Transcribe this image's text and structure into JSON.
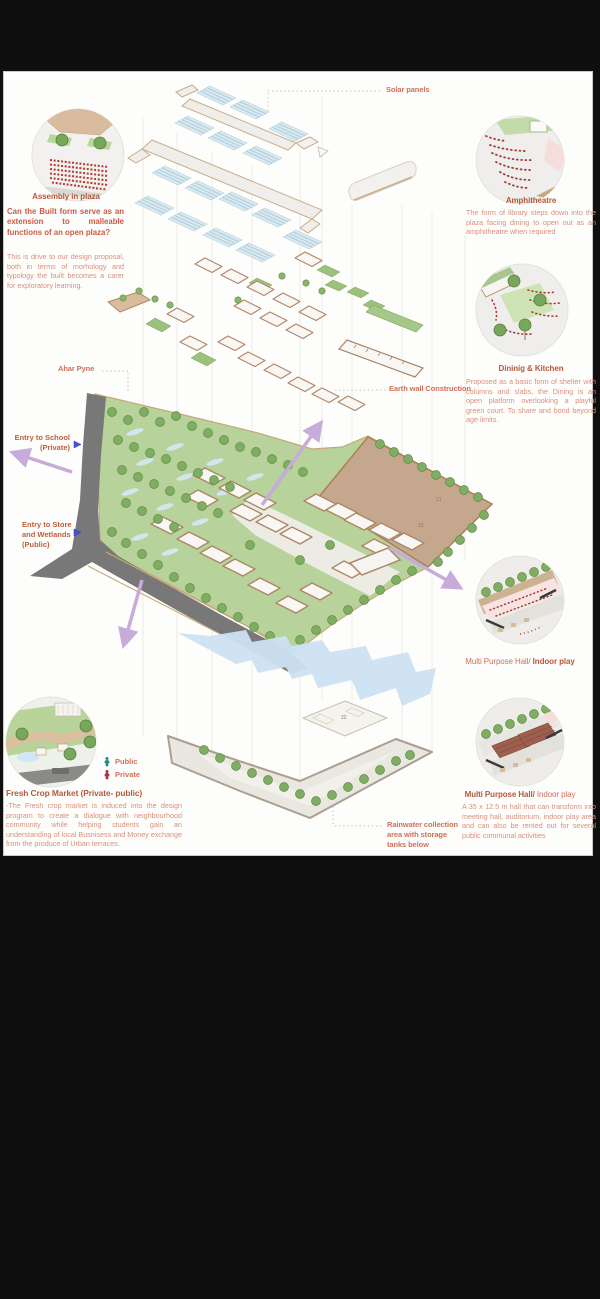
{
  "accents": {
    "heading": "#b6593c",
    "question": "#cb5a43",
    "body_text": "#d9907b",
    "label": "#d0705a",
    "arrow": "#c7abd8",
    "public_icon": "#1f8a8a",
    "private_icon": "#a8333d"
  },
  "annotations": {
    "solar_panels": "Solar panels",
    "ahar_pyne": "Ahar Pyne",
    "earth_wall": "Earth wall Construction",
    "entry_school": [
      "Entry to School",
      "(Private)"
    ],
    "entry_store": [
      "Entry to Store",
      "and Wetlands",
      "(Public)"
    ],
    "rainwater": [
      "Rainwater collection",
      "area with storage",
      "tanks below"
    ]
  },
  "legend": {
    "public_label": "Public",
    "private_label": "Private"
  },
  "callouts": {
    "assembly": {
      "title": "Assembly in  plaza",
      "question": "Can the Built form serve as an extension to malleable functions of an open plaza?",
      "body": "This is drive to our design proposal, both in terms of morhology and typology the built becomes a carer for exploratory learning."
    },
    "amphitheatre": {
      "title": "Amphitheatre",
      "body": "The form of  library steps down into the plaza facing dining to open out as an amphitheatre when required"
    },
    "dining": {
      "title": "Dininig & Kitchen",
      "body": "Proposed as a basic form of shelter with columns and slabs, the Dining is an open platform overlooking a playful green court. To share and bond beyond age limits."
    },
    "mph_top": {
      "title_regular": "Multi Purpose Hall/",
      "title_bold": " Indoor play"
    },
    "mph_bottom": {
      "title_bold": "Multi Purpose Hall/",
      "title_regular": " Indoor play",
      "body": "A 35 x 12.5 m hall that can transform into meeting hall, auditorium, indoor play area and can also be rented out for several public communal activities"
    },
    "fresh_market": {
      "title": "Fresh Crop Market (Private- public)",
      "body": "-The Fresh crop market is induced into the design program to create a dialogue with neighbourhood community while helping students gain an understanding of local Busnisess and Money exchange from the produce of  Urban terraces."
    }
  },
  "plan_numbers": {
    "field_a": "21",
    "field_b": "22",
    "field_c": "14",
    "tank": "22"
  }
}
